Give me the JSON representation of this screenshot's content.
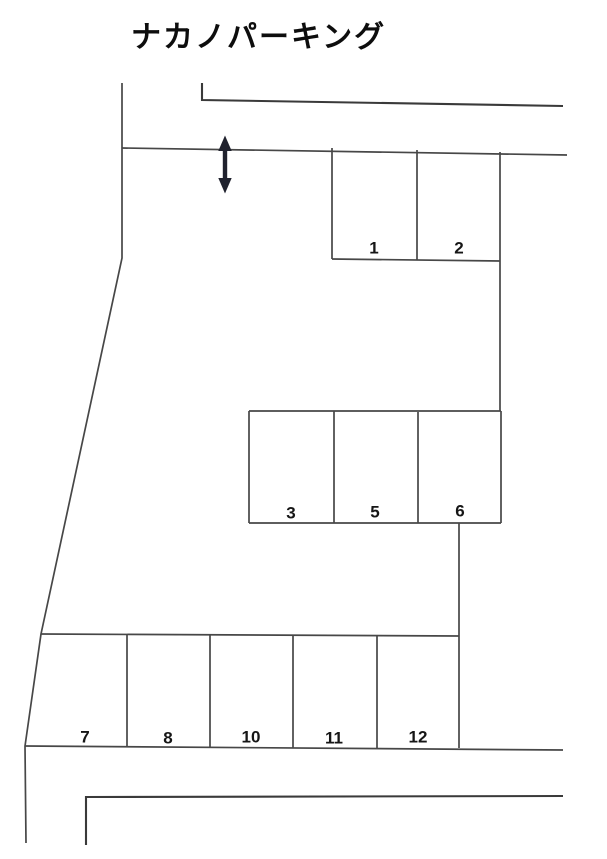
{
  "page": {
    "title": "ナカノパーキング"
  },
  "icons": {
    "entrance_arrow": "↕"
  },
  "lot": {
    "blocks": [
      {
        "name": "upper-block",
        "spaces": [
          "1",
          "2"
        ]
      },
      {
        "name": "middle-block",
        "spaces": [
          "3",
          "5",
          "6"
        ]
      },
      {
        "name": "lower-row",
        "spaces": [
          "7",
          "8",
          "10",
          "11",
          "12"
        ]
      }
    ]
  },
  "colors": {
    "background": "#ffffff",
    "boundary_line": "#474747",
    "road_line": "#3a3a3a",
    "arrow": "#20222e",
    "text": "#161616"
  }
}
